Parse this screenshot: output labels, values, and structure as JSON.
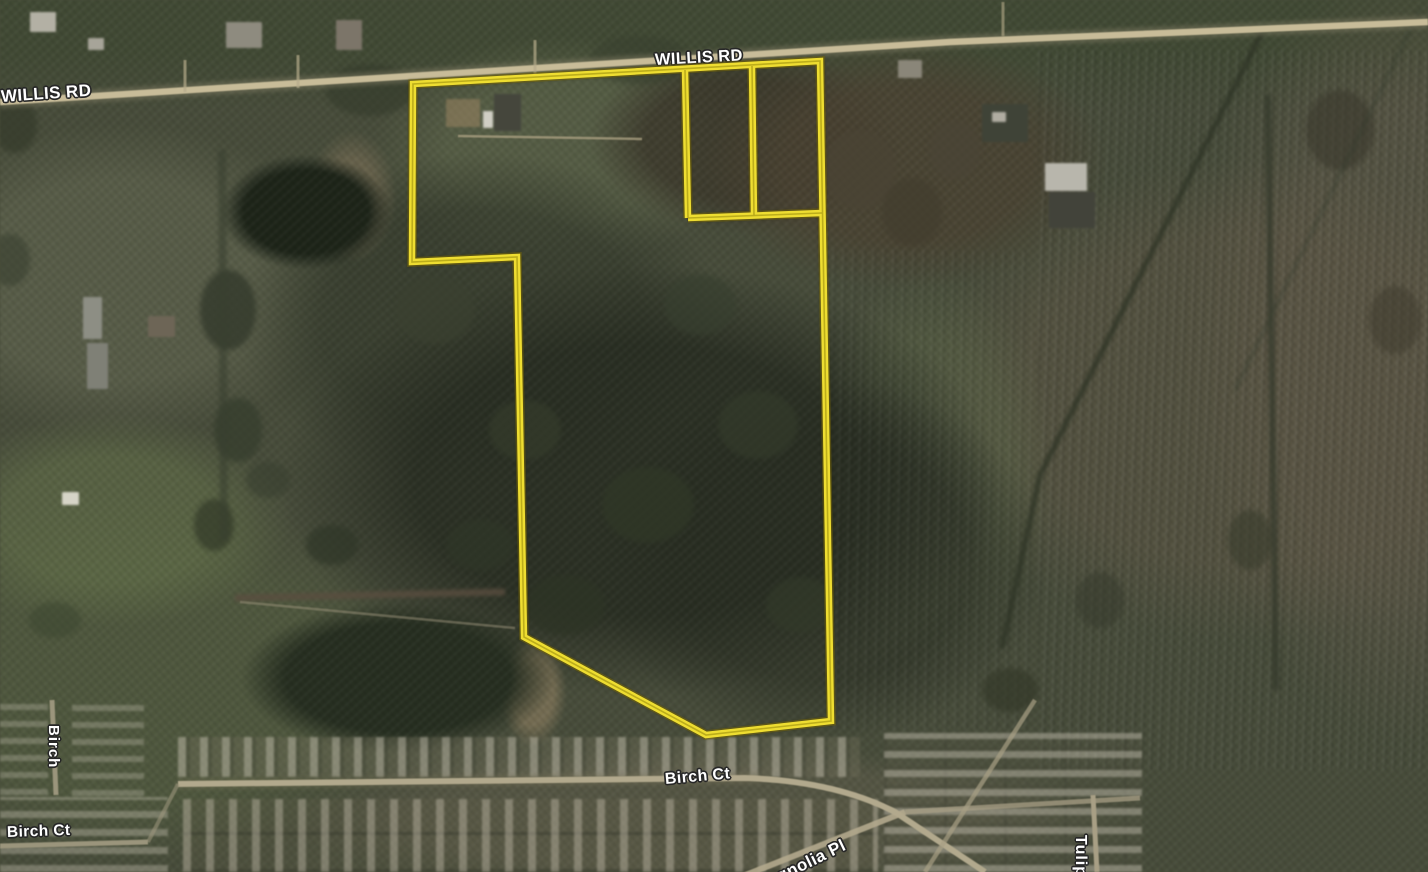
{
  "map": {
    "view_type": "satellite",
    "labels": {
      "willis_left": "WILLIS RD",
      "willis_center": "WILLIS RD",
      "birch_vertical": "Birch",
      "birch_ct_left": "Birch Ct",
      "birch_ct_center": "Birch Ct",
      "magnolia": "Magnolia Pl",
      "tulip": "Tulip"
    },
    "parcel_outline": {
      "color": "#eedd31",
      "outer": [
        [
          413,
          84
        ],
        [
          820,
          61
        ],
        [
          831,
          721
        ],
        [
          706,
          735
        ],
        [
          524,
          637
        ],
        [
          517,
          257
        ],
        [
          412,
          262
        ]
      ],
      "inner_lines": [
        [
          [
            685,
            70
          ],
          [
            688,
            218
          ]
        ],
        [
          [
            752,
            66
          ],
          [
            754,
            216
          ]
        ],
        [
          [
            688,
            218
          ],
          [
            822,
            213
          ]
        ]
      ]
    },
    "colors": {
      "parcel_boundary": "#eedd31",
      "road_fill": "#c8bc99",
      "label_text": "#ffffff",
      "terrain_base": "#474c39"
    }
  }
}
